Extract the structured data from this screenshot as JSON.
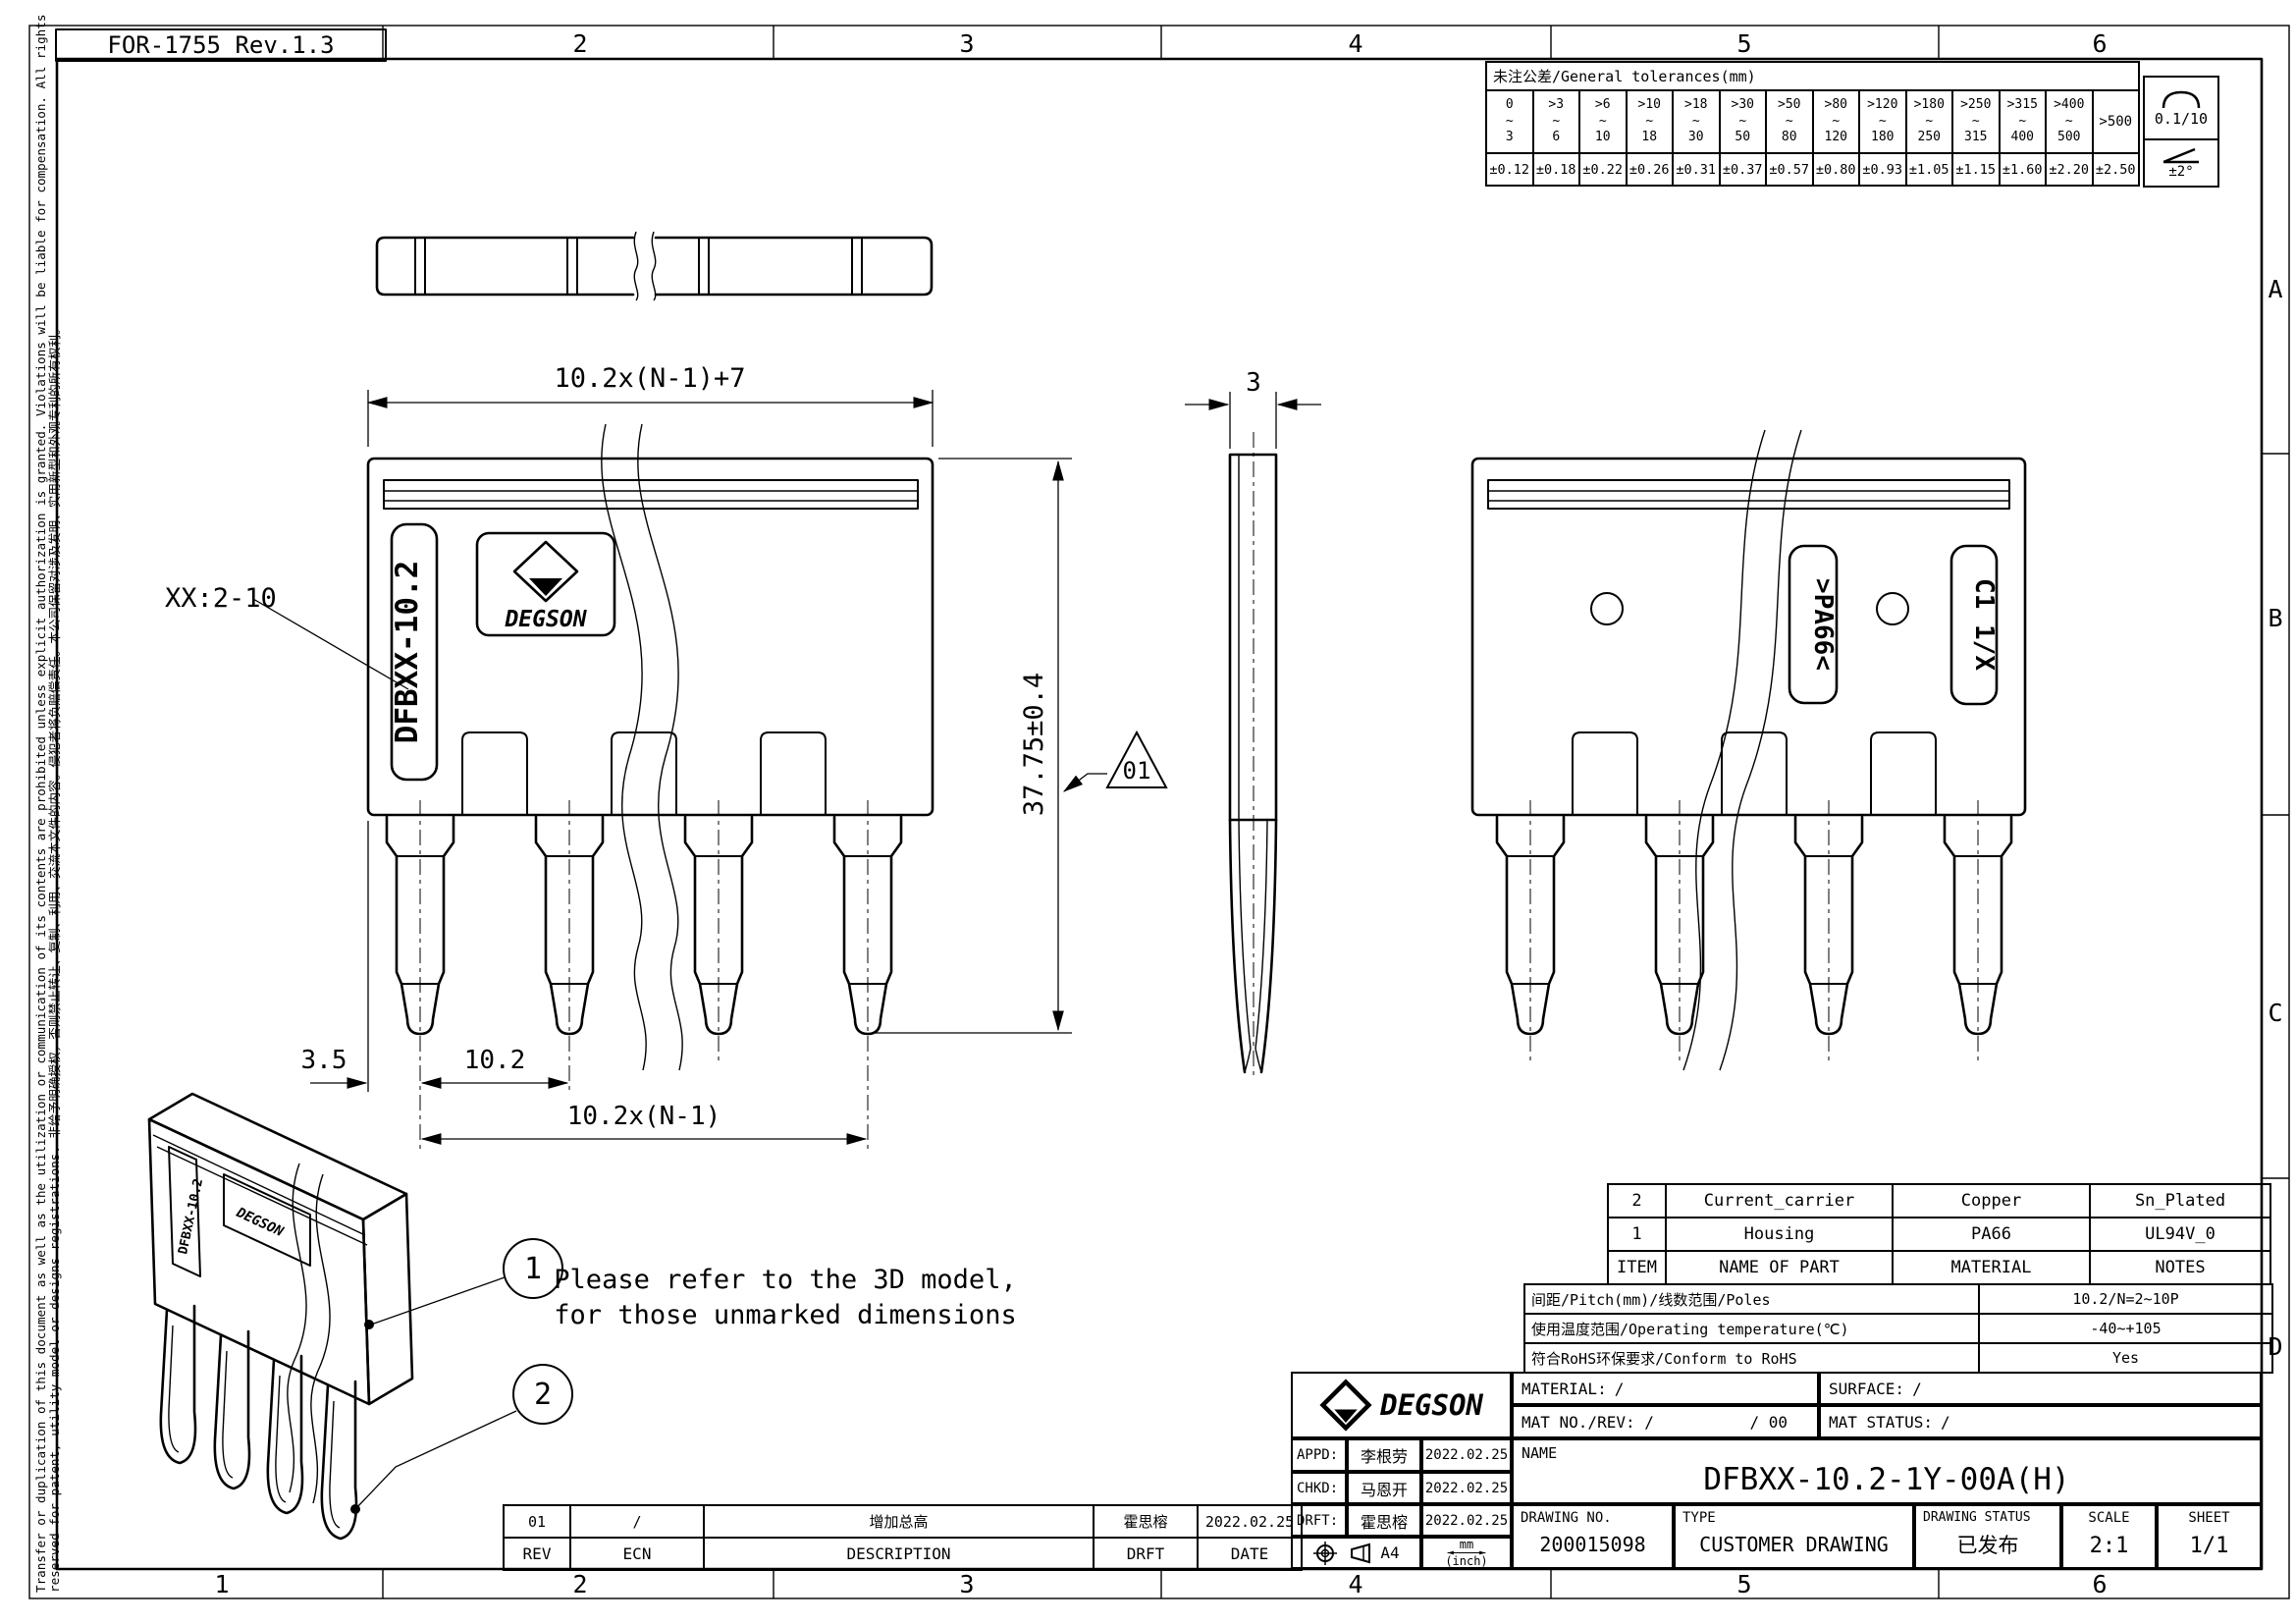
{
  "form_code": "FOR-1755 Rev.1.3",
  "frame": {
    "cols_top": [
      "2",
      "3",
      "4",
      "5",
      "6"
    ],
    "cols_bottom": [
      "1",
      "2",
      "3",
      "4",
      "5",
      "6"
    ],
    "rows_right": [
      "A",
      "B",
      "C",
      "D"
    ],
    "disclaimer_line1": "Transfer or duplication of this document as well as the utilization or communication of its contents are prohibited unless explicit authorization is granted. Violations will be liable for compensation. All rights",
    "disclaimer_line2": "reserved for patent, utility model or designs registrations. 非给予明确授权，否则禁止转让、复制、利用、交流本文件的内容。侵犯者将负赔偿责任。本公司保留对涉及发明、实用新型和外观专利的所有权利。"
  },
  "tolerance_table": {
    "title": "未注公差/General tolerances(mm)",
    "cols": [
      {
        "top": "0",
        "mid": "~",
        "bottom": "3",
        "tol": "±0.12"
      },
      {
        "top": ">3",
        "mid": "~",
        "bottom": "6",
        "tol": "±0.18"
      },
      {
        "top": ">6",
        "mid": "~",
        "bottom": "10",
        "tol": "±0.22"
      },
      {
        "top": ">10",
        "mid": "~",
        "bottom": "18",
        "tol": "±0.26"
      },
      {
        "top": ">18",
        "mid": "~",
        "bottom": "30",
        "tol": "±0.31"
      },
      {
        "top": ">30",
        "mid": "~",
        "bottom": "50",
        "tol": "±0.37"
      },
      {
        "top": ">50",
        "mid": "~",
        "bottom": "80",
        "tol": "±0.57"
      },
      {
        "top": ">80",
        "mid": "~",
        "bottom": "120",
        "tol": "±0.80"
      },
      {
        "top": ">120",
        "mid": "~",
        "bottom": "180",
        "tol": "±0.93"
      },
      {
        "top": ">180",
        "mid": "~",
        "bottom": "250",
        "tol": "±1.05"
      },
      {
        "top": ">250",
        "mid": "~",
        "bottom": "315",
        "tol": "±1.15"
      },
      {
        "top": ">315",
        "mid": "~",
        "bottom": "400",
        "tol": "±1.60"
      },
      {
        "top": ">400",
        "mid": "~",
        "bottom": "500",
        "tol": "±2.20"
      }
    ],
    "last_col": {
      "label": ">500",
      "tol": "±2.50"
    },
    "flatness": "0.1/10",
    "angle": "±2°"
  },
  "drawing": {
    "dim_width": "10.2x(N-1)+7",
    "dim_height": "37.75±0.4",
    "dim_thickness": "3",
    "dim_offset": "3.5",
    "dim_pitch": "10.2",
    "dim_span": "10.2x(N-1)",
    "rev_flag": "01",
    "poles_note": "XX:2-10",
    "marking_part": "DFBXX-10.2",
    "brand": "DEGSON",
    "marking_material": ">PA66<",
    "marking_cavity": "C1 1/X",
    "callout_1": "1",
    "callout_2": "2",
    "note_line1": "Please refer to the 3D model,",
    "note_line2": "for those unmarked dimensions"
  },
  "parts_table": {
    "headers": {
      "item": "ITEM",
      "name": "NAME OF PART",
      "material": "MATERIAL",
      "notes": "NOTES"
    },
    "rows": [
      {
        "item": "2",
        "name": "Current_carrier",
        "material": "Copper",
        "notes": "Sn_Plated"
      },
      {
        "item": "1",
        "name": "Housing",
        "material": "PA66",
        "notes": "UL94V_0"
      }
    ]
  },
  "specs": {
    "rows": [
      {
        "label": "间距/Pitch(mm)/线数范围/Poles",
        "value": "10.2/N=2~10P"
      },
      {
        "label": "使用温度范围/Operating temperature(℃)",
        "value": "-40~+105"
      },
      {
        "label": "符合RoHS环保要求/Conform to RoHS",
        "value": "Yes"
      }
    ]
  },
  "title_block": {
    "brand": "DEGSON",
    "material_label": "MATERIAL:",
    "material_value": "/",
    "surface_label": "SURFACE:",
    "surface_value": "/",
    "mat_no_label": "MAT NO./REV:",
    "mat_no_value": "/",
    "mat_rev_value": "/ 00",
    "mat_status_label": "MAT STATUS:",
    "mat_status_value": "/",
    "appd_label": "APPD:",
    "appd_name": "李根劳",
    "appd_date": "2022.02.25",
    "chkd_label": "CHKD:",
    "chkd_name": "马恩开",
    "chkd_date": "2022.02.25",
    "drft_label": "DRFT:",
    "drft_name": "霍思榕",
    "drft_date": "2022.02.25",
    "paper_size": "A4",
    "units_top": "mm",
    "units_bottom": "(inch)",
    "name_label": "NAME",
    "part_name": "DFBXX-10.2-1Y-00A(H)",
    "drawing_no_label": "DRAWING NO.",
    "drawing_no": "200015098",
    "type_label": "TYPE",
    "type_value": "CUSTOMER DRAWING",
    "status_label": "DRAWING STATUS",
    "status_value": "已发布",
    "scale_label": "SCALE",
    "scale_value": "2:1",
    "sheet_label": "SHEET",
    "sheet_value": "1/1"
  },
  "revision_table": {
    "headers": {
      "rev": "REV",
      "ecn": "ECN",
      "description": "DESCRIPTION",
      "drft": "DRFT",
      "date": "DATE"
    },
    "rows": [
      {
        "rev": "01",
        "ecn": "/",
        "description": "增加总高",
        "drft": "霍思榕",
        "date": "2022.02.25"
      }
    ]
  }
}
